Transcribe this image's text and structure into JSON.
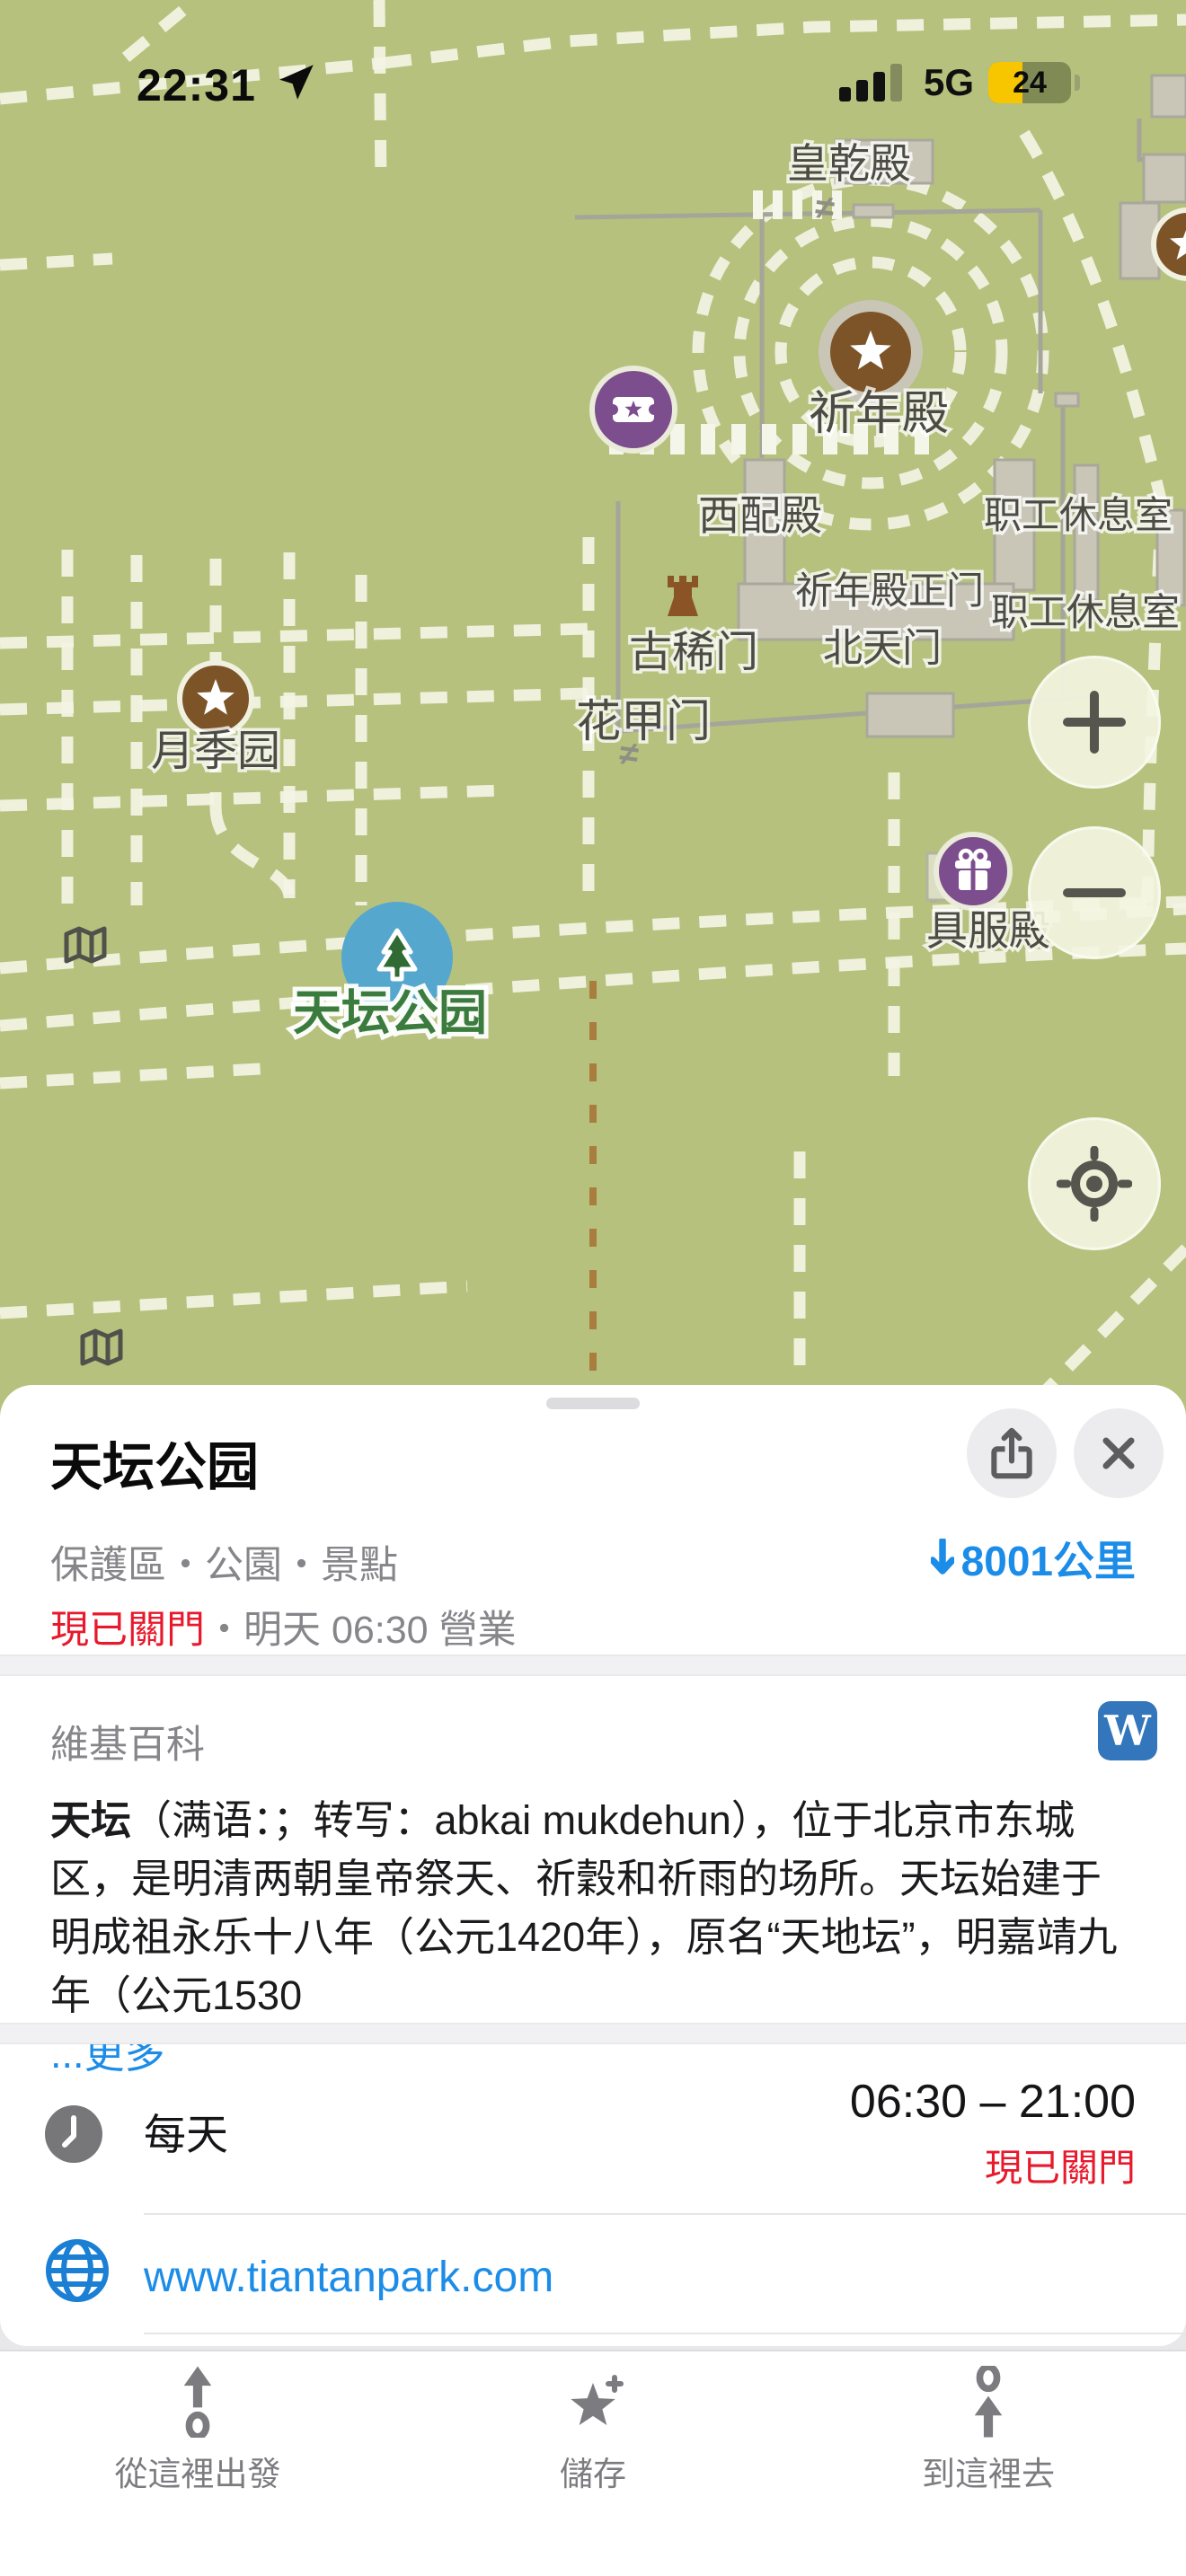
{
  "status_bar": {
    "time": "22:31",
    "network": "5G",
    "battery_percent": "24"
  },
  "map": {
    "labels": [
      "皇乾殿",
      "祈年殿",
      "西配殿",
      "职工休息室",
      "祈年殿正门",
      "职工休息室",
      "古稀门",
      "北天门",
      "花甲门",
      "月季园",
      "具服殿",
      "天坛公园"
    ],
    "gate_glyph": "≠",
    "colors": {
      "background": "#b6c17d",
      "park_label_green": "#3b7c3e",
      "poi_brown": "#7d5428",
      "poi_purple": "#7c4e8d",
      "park_marker_blue": "#56a7cd"
    }
  },
  "controls": {
    "zoom_in": "+",
    "zoom_out": "−"
  },
  "sheet": {
    "title": "天坛公园",
    "category": "保護區・公園・景點",
    "distance": "8001公里",
    "status_closed": "現已關門",
    "status_open_info": "・明天 06:30 營業",
    "wikipedia": {
      "label": "維基百科",
      "icon_letter": "W",
      "paragraph_lead": "天坛",
      "paragraph_rest": "（满语：；转写：abkai mukdehun），位于北京市东城区，是明清两朝皇帝祭天、祈穀和祈雨的场所。天坛始建于明成祖永乐十八年（公元1420年），原名“天地坛”，明嘉靖九年（公元1530",
      "more_link": "...更多"
    },
    "hours": {
      "label": "每天",
      "time": "06:30 – 21:00",
      "status": "現已關門"
    },
    "website": "www.tiantanpark.com"
  },
  "toolbar": {
    "from_here": "從這裡出發",
    "save": "儲存",
    "to_here": "到這裡去"
  },
  "colors": {
    "accent_blue": "#1b8ce8",
    "closed_red": "#e8192c",
    "battery_yellow": "#f7c600"
  }
}
